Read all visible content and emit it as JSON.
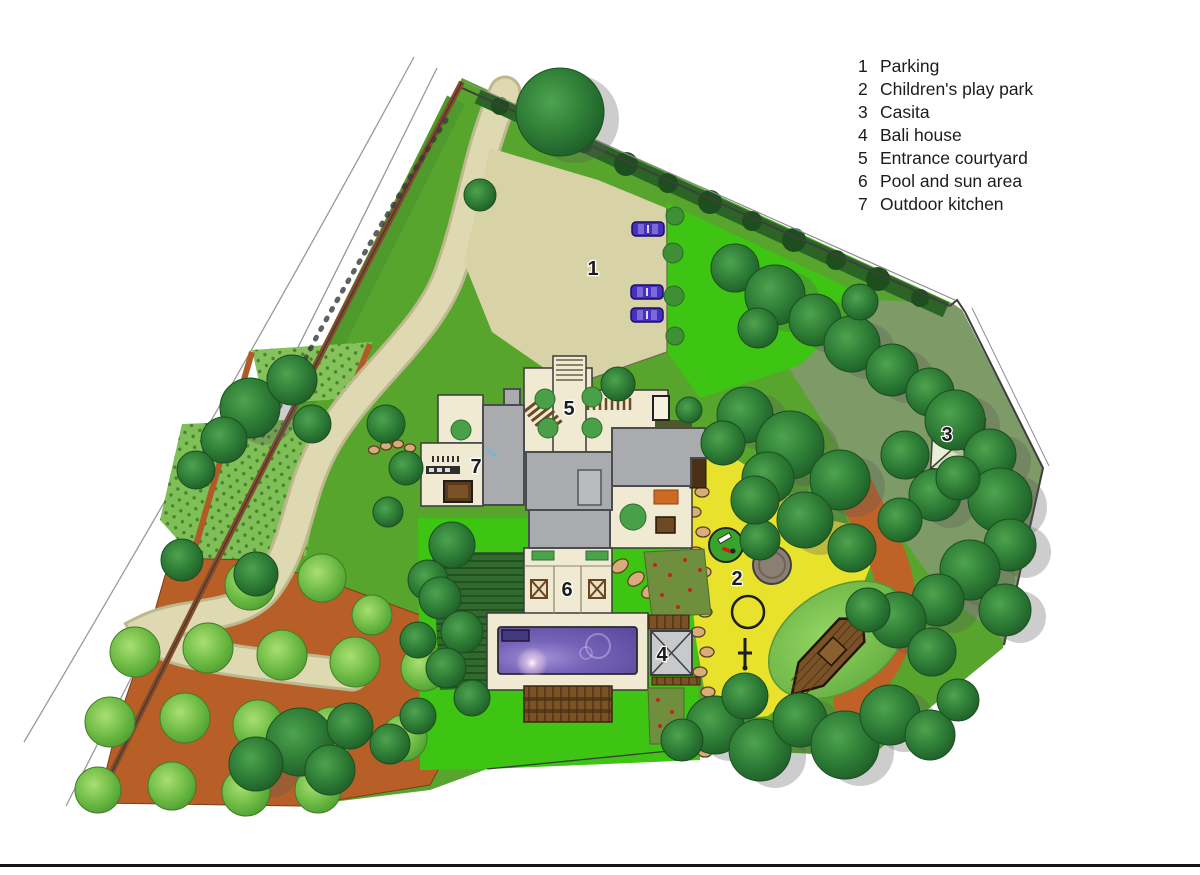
{
  "legend": {
    "items": [
      {
        "num": "1",
        "label": "Parking"
      },
      {
        "num": "2",
        "label": "Children's play park"
      },
      {
        "num": "3",
        "label": "Casita"
      },
      {
        "num": "4",
        "label": "Bali house"
      },
      {
        "num": "5",
        "label": "Entrance courtyard"
      },
      {
        "num": "6",
        "label": "Pool and sun area"
      },
      {
        "num": "7",
        "label": "Outdoor kitchen"
      }
    ]
  },
  "plan_labels": {
    "parking": "1",
    "children_play_park": "2",
    "casita": "3",
    "bali_house": "4",
    "entrance_courtyard": "5",
    "pool_and_sun_area": "6",
    "outdoor_kitchen": "7"
  },
  "palette": {
    "lawn_green": "#3ec513",
    "planting_green": "#57a52c",
    "hedge_green": "#2b6425",
    "sage_green": "#7e9a66",
    "driveway_cream": "#ddd8ae",
    "courtyard_cream": "#f0ead2",
    "orchard_terracotta": "#b85f28",
    "play_park_yellow": "#e9e22c",
    "pool_purple": "#6857b2",
    "roof_gray": "#a9abae",
    "wood_brown": "#7a5226",
    "boundary_wall_brown": "#8a4a28"
  }
}
